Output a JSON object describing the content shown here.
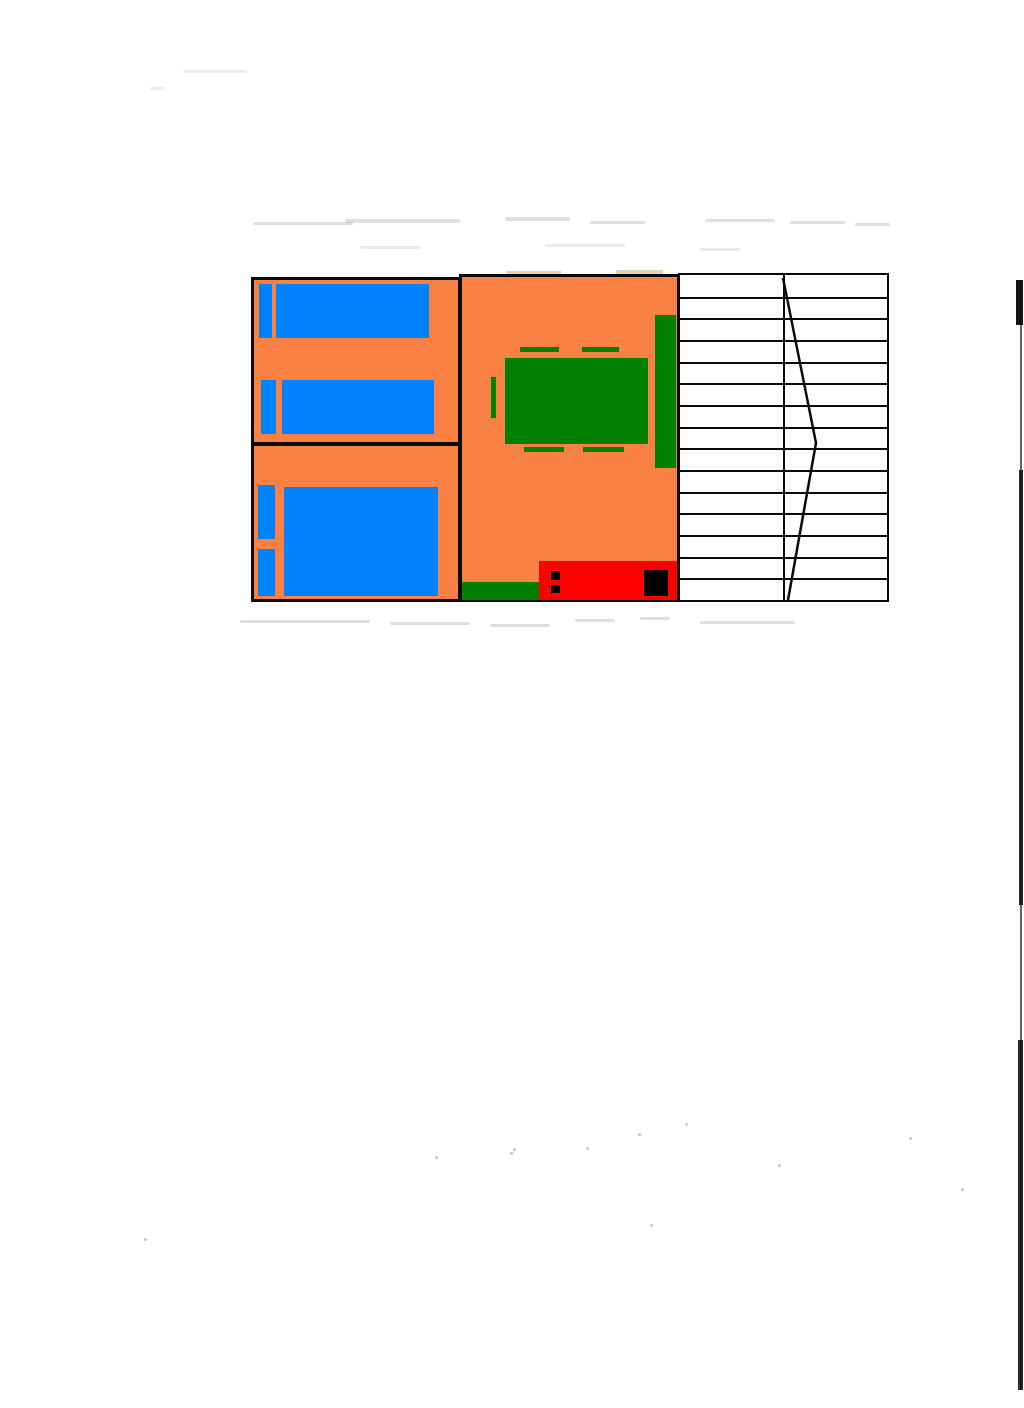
{
  "document": {
    "kind": "scanned hand-drawn floor plan"
  },
  "palette": {
    "paper": "#ffffff",
    "wall_line": "#0a0a0a",
    "floor_orange": "#F98143",
    "bed_blue": "#0182FD",
    "furniture_green": "#008000",
    "counter_red": "#FE0000",
    "appliance_black": "#000000",
    "smudge_gray": "#b9b9b9",
    "smudge_tan": "#DBCCA4"
  },
  "plan": {
    "rooms": [
      {
        "id": "bedroom-1",
        "label": "twin bedroom",
        "furniture": [
          "single-bed",
          "single-bed"
        ]
      },
      {
        "id": "bedroom-2",
        "label": "double bedroom",
        "furniture": [
          "double-bed"
        ]
      },
      {
        "id": "living-kitchen",
        "label": "living-kitchen room",
        "furniture": [
          "dining-table",
          "chair-marks",
          "sofa-bench",
          "kitchen-counter",
          "door-mat"
        ]
      },
      {
        "id": "deck-stairs",
        "label": "deck-stairs area",
        "furniture": [
          "tread-lines",
          "direction-chevron"
        ]
      }
    ],
    "counts": {
      "single_beds": 2,
      "double_beds": 1,
      "pillows": 4,
      "chair_marks": 5
    }
  },
  "stairs": {
    "tread_count": 15
  }
}
